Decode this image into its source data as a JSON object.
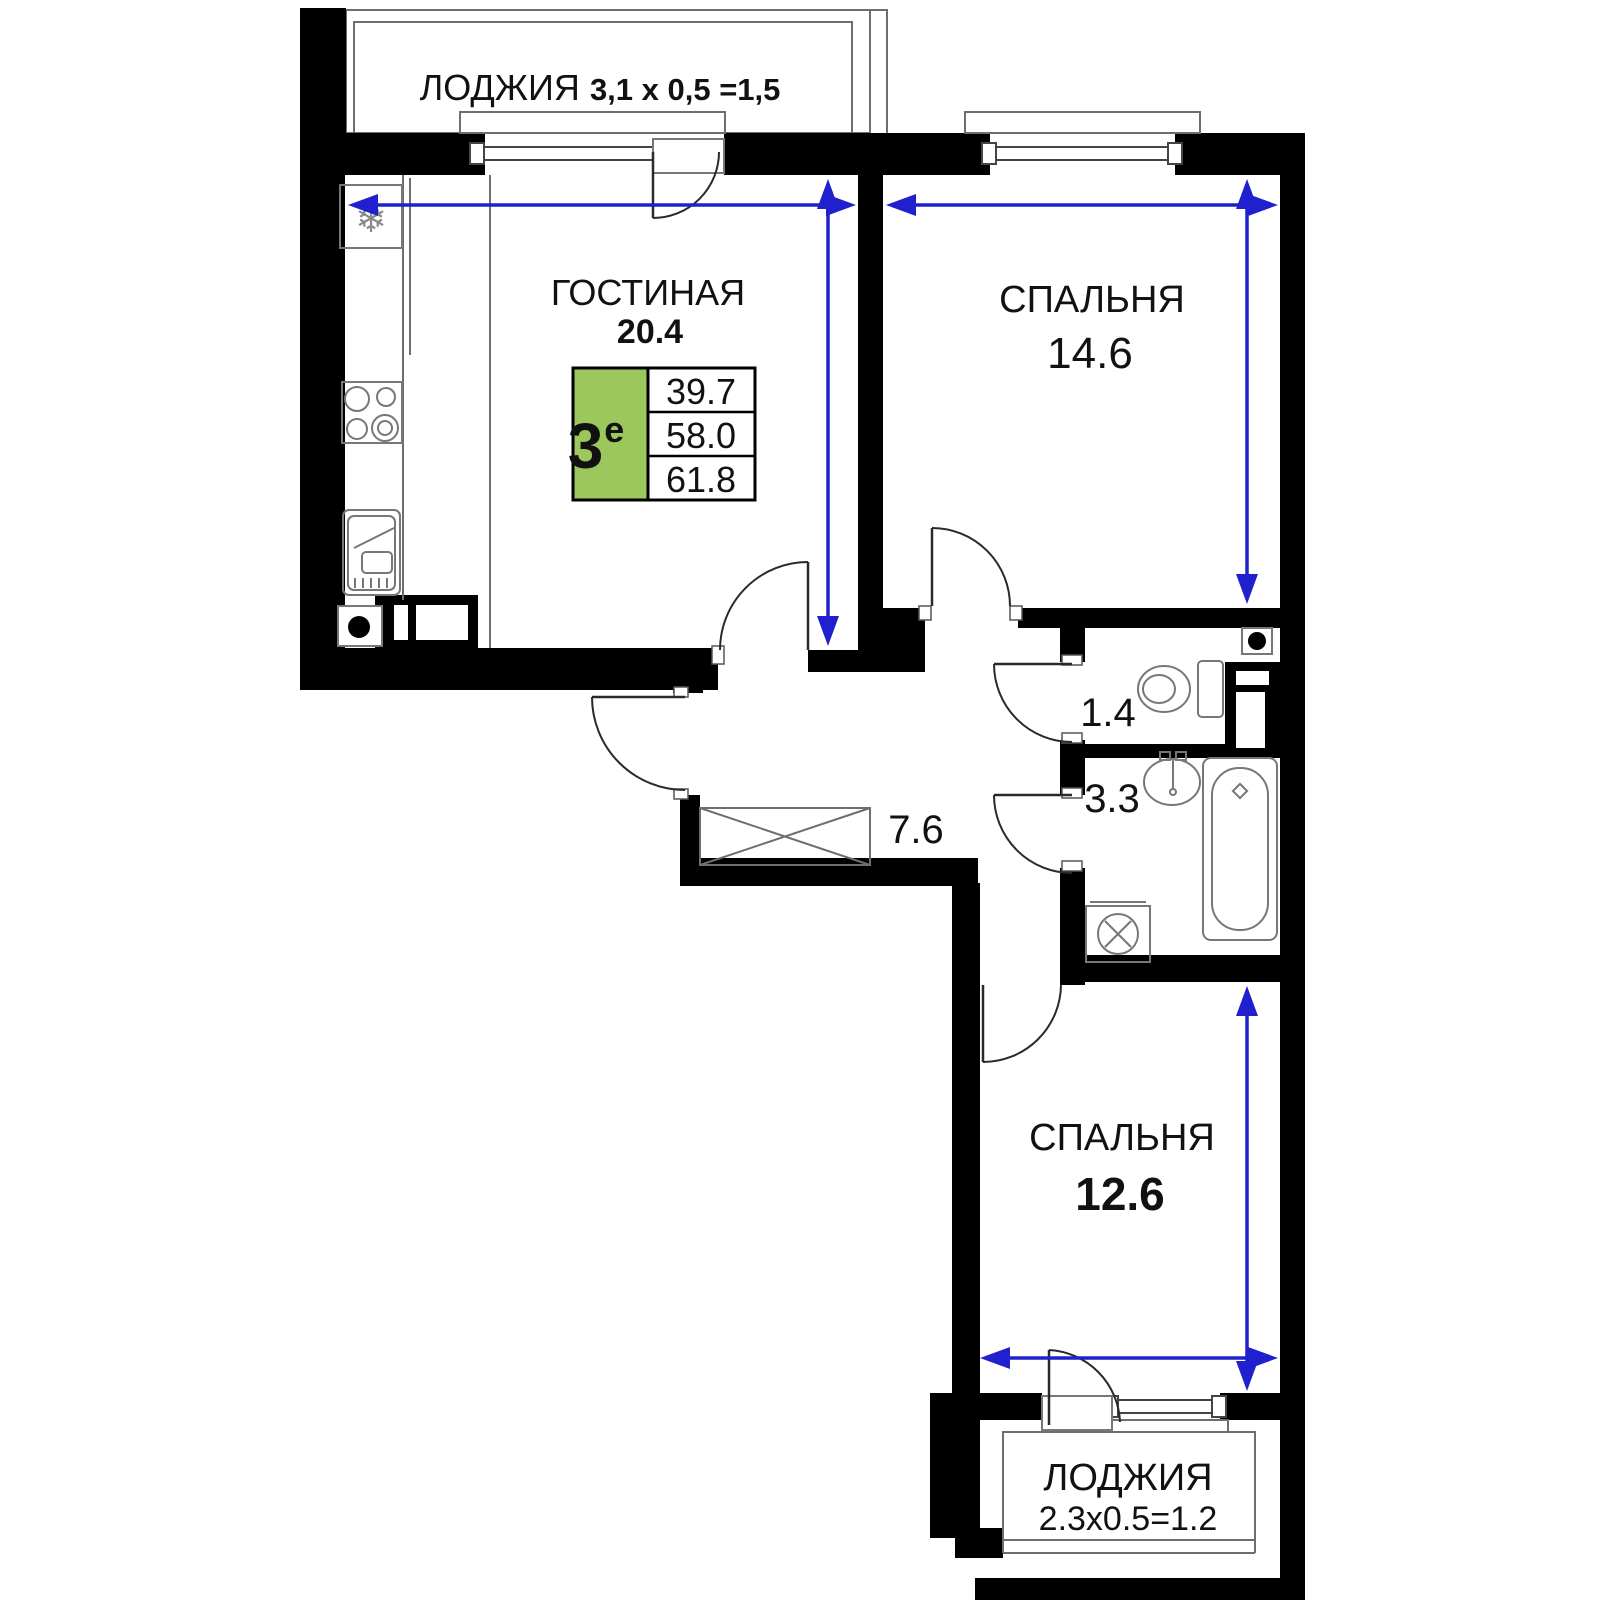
{
  "plan": {
    "colors": {
      "wall": "#000000",
      "dimension": "#2020cf",
      "badge_green": "#9cc75c",
      "line": "#6e6e6e"
    },
    "icons": {
      "snowflake": "❄"
    },
    "unit_badge": {
      "rooms": "3",
      "suffix": "е",
      "area_living": "39.7",
      "area_main": "58.0",
      "area_total": "61.8"
    },
    "loggia_top": {
      "name": "ЛОДЖИЯ",
      "dims": "3,1 х 0,5 =1,5"
    },
    "living": {
      "name": "ГОСТИНАЯ",
      "area": "20.4"
    },
    "bedroom1": {
      "name": "СПАЛЬНЯ",
      "area": "14.6"
    },
    "wc": {
      "area": "1.4"
    },
    "bath": {
      "area": "3.3"
    },
    "hall": {
      "area": "7.6"
    },
    "bedroom2": {
      "name": "СПАЛЬНЯ",
      "area": "12.6"
    },
    "loggia_bottom": {
      "name": "ЛОДЖИЯ",
      "dims": "2.3х0.5=1.2"
    }
  }
}
